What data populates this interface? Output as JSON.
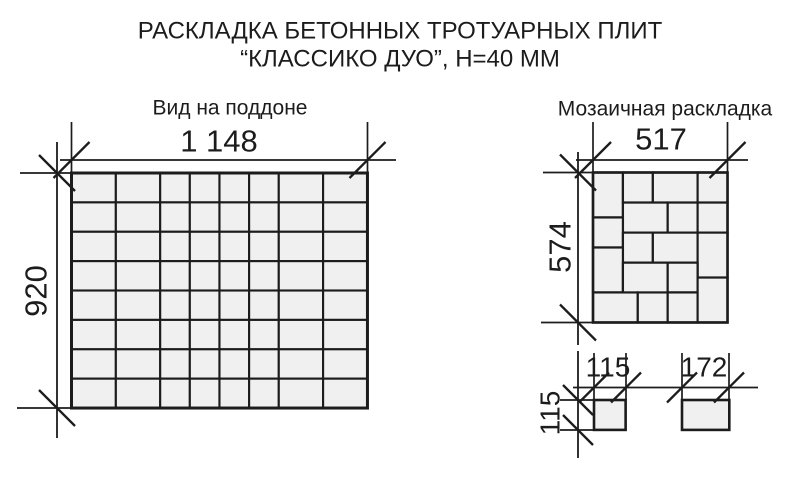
{
  "title": {
    "line1": "РАСКЛАДКА БЕТОННЫХ ТРОТУАРНЫХ ПЛИТ",
    "line2": "“КЛАССИКО ДУО”, Н=40 ММ"
  },
  "pallet": {
    "label": "Вид на поддоне",
    "dim_width": "1 148",
    "dim_height": "920",
    "columns_mm": [
      172,
      172,
      115,
      115,
      115,
      115,
      172,
      172
    ],
    "rows": 8,
    "row_height_mm": 115
  },
  "mosaic": {
    "label": "Мозаичная раскладка",
    "dim_width": "517",
    "dim_height": "574",
    "tiles_mm": [
      [
        0,
        0,
        115,
        172
      ],
      [
        115,
        0,
        115,
        115
      ],
      [
        230,
        0,
        172,
        115
      ],
      [
        402,
        0,
        115,
        115
      ],
      [
        115,
        115,
        172,
        115
      ],
      [
        287,
        115,
        115,
        115
      ],
      [
        402,
        115,
        115,
        115
      ],
      [
        0,
        172,
        115,
        115
      ],
      [
        115,
        230,
        115,
        115
      ],
      [
        230,
        230,
        172,
        115
      ],
      [
        402,
        230,
        115,
        172
      ],
      [
        0,
        287,
        115,
        172
      ],
      [
        115,
        345,
        172,
        115
      ],
      [
        287,
        345,
        115,
        114
      ],
      [
        0,
        459,
        172,
        115
      ],
      [
        172,
        459,
        115,
        115
      ],
      [
        287,
        459,
        115,
        115
      ],
      [
        402,
        402,
        115,
        172
      ]
    ]
  },
  "samples": {
    "square": {
      "dim_width": "115",
      "dim_height": "115",
      "w_mm": 115,
      "h_mm": 115
    },
    "rect": {
      "dim_width": "172",
      "w_mm": 172,
      "h_mm": 115
    }
  },
  "colors": {
    "line": "#1c1c1c",
    "tile_fill": "#f0f0f0",
    "background": "#ffffff"
  }
}
